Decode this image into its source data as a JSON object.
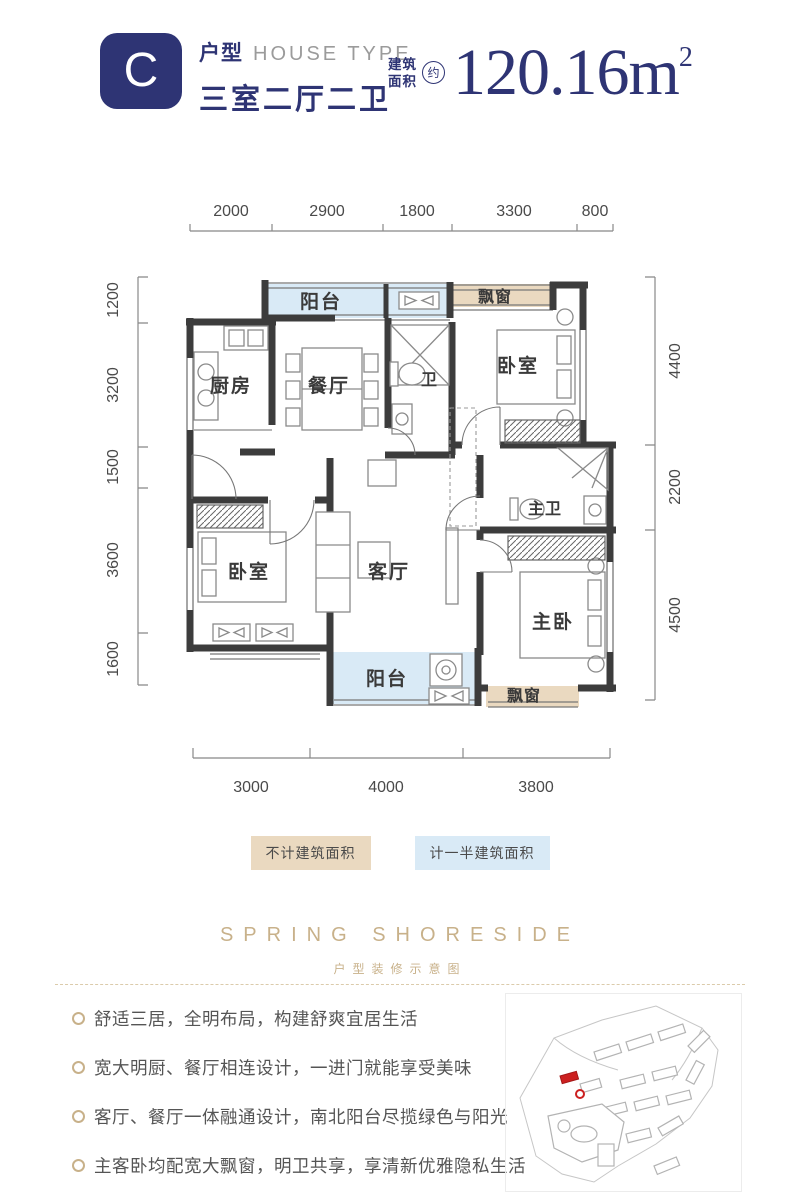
{
  "colors": {
    "navy": "#2e3474",
    "gray": "#9b9b9b",
    "gold": "#c8b18a",
    "tan": "#ead9c0",
    "blue": "#d9eaf6",
    "wall": "#3c3c3c",
    "red": "#cc2020",
    "dimtext": "#4a4a4a"
  },
  "header": {
    "badge": "C",
    "type_zh": "户型",
    "type_en": "HOUSE TYPE",
    "layout": "三室二厅二卫",
    "area_prefix_1": "建筑",
    "area_prefix_2": "面积",
    "area_approx": "约",
    "area_value": "120.16m",
    "area_sup": "2"
  },
  "plan": {
    "rooms": {
      "balcony_top": "阳台",
      "bay_top": "飘窗",
      "kitchen": "厨房",
      "dining": "餐厅",
      "bath": "卫",
      "bedroom_top": "卧室",
      "bedroom_left": "卧室",
      "living": "客厅",
      "master_bath": "主卫",
      "master_bedroom": "主卧",
      "balcony_bottom": "阳台",
      "bay_bottom": "飘窗"
    },
    "dims": {
      "top": [
        "2000",
        "2900",
        "1800",
        "3300",
        "800"
      ],
      "bottom": [
        "3000",
        "4000",
        "3800"
      ],
      "left": [
        "1200",
        "3200",
        "1500",
        "3600",
        "1600"
      ],
      "right": [
        "4400",
        "2200",
        "4500"
      ]
    }
  },
  "legend": {
    "items": [
      {
        "label": "不计建筑面积"
      },
      {
        "label": "计一半建筑面积"
      }
    ]
  },
  "branding": {
    "name": "SPRING SHORESIDE",
    "subtitle": "户型装修示意图"
  },
  "features": {
    "items": [
      "舒适三居，全明布局，构建舒爽宜居生活",
      "宽大明厨、餐厅相连设计，一进门就能享受美味",
      "客厅、餐厅一体融通设计，南北阳台尽揽绿色与阳光",
      "主客卧均配宽大飘窗，明卫共享，享清新优雅隐私生活"
    ]
  }
}
